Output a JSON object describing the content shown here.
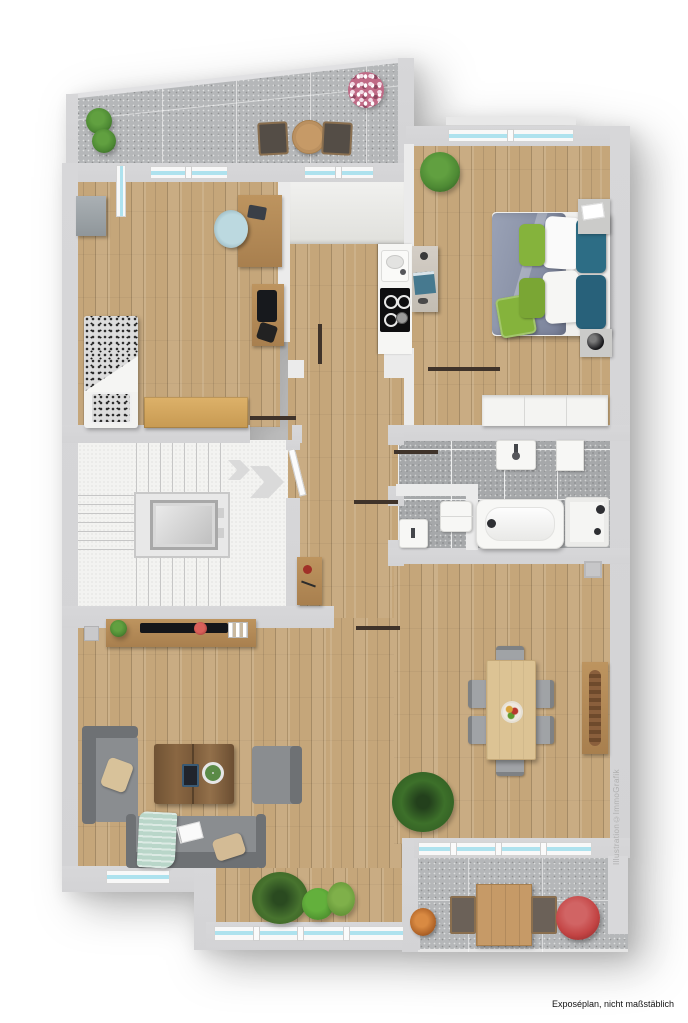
{
  "captions": {
    "watermark_vertical": "Illustration©ImmoGrafik",
    "footer_note": "Exposéplan, nicht maßstäblich"
  },
  "colors": {
    "wall": "#d3d3d5",
    "wall_inner": "#ebebeb",
    "wood_floor": "#c5a67a",
    "concrete": "#b5b7b9",
    "bath_tile": "#a6a8aa",
    "stair_floor": "#f3f3f1",
    "window_glass": "#aee2ee",
    "door_leaf": "#3f332a",
    "sofa_gray": "#8a8d90",
    "duvet_gray_blue": "#8b93a8",
    "pillow_green": "#85b33c",
    "pillow_teal": "#2d6d85",
    "plant_green": "#4e8a34",
    "flower_pink": "#c06a86",
    "flower_red": "#c34444",
    "text_gray": "#b0b0b0",
    "text_black": "#121212"
  }
}
